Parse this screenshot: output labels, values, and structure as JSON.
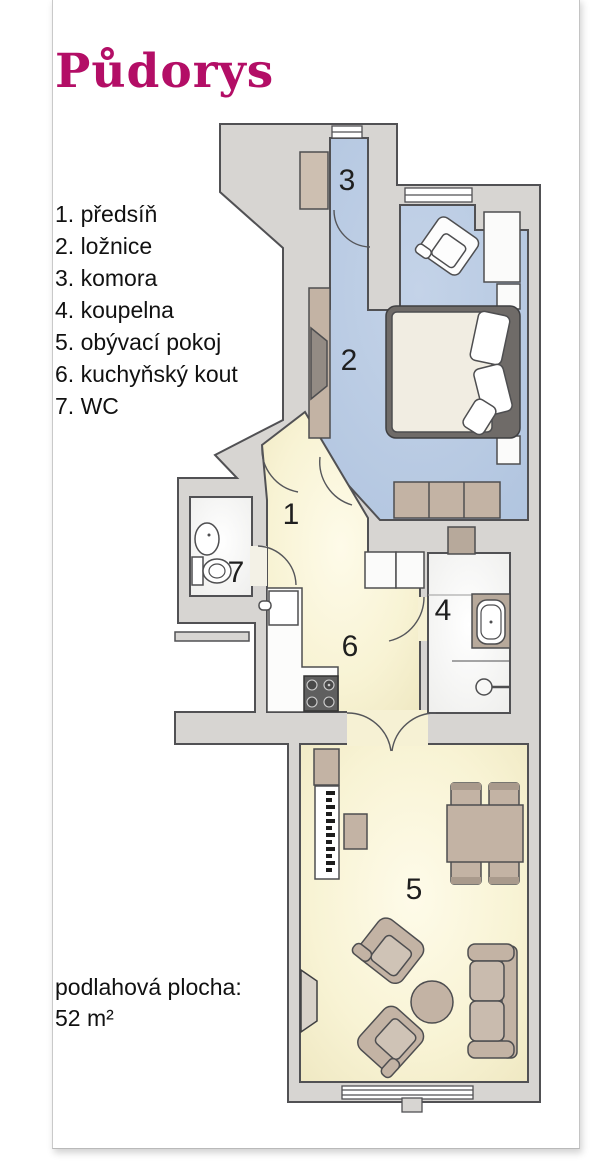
{
  "title": "Půdorys",
  "legend": {
    "items": [
      "1. předsíň",
      "2. ložnice",
      "3. komora",
      "4. koupelna",
      "5. obývací pokoj",
      "6. kuchyňský kout",
      "7. WC"
    ]
  },
  "plan": {
    "room_numbers": [
      "1",
      "2",
      "3",
      "4",
      "5",
      "6",
      "7"
    ]
  },
  "footer": {
    "label": "podlahová plocha:",
    "value": "52 m²"
  },
  "colors": {
    "title_accent": "#b30e66",
    "room_blue": "#b7cae3",
    "room_yellow": "#f7f2d2",
    "room_white": "#f8f8f6",
    "wall_gray": "#d7d5d2",
    "furniture_tan": "#c3b3a4"
  }
}
